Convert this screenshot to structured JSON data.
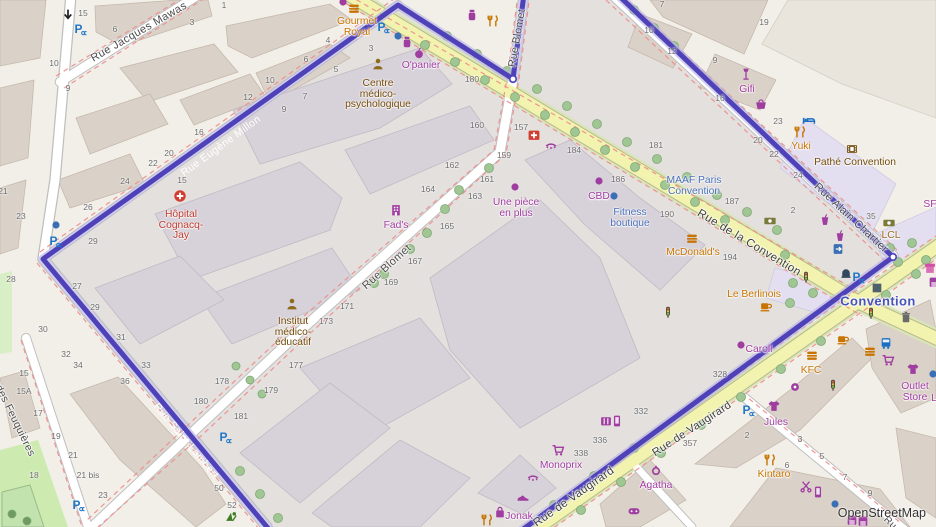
{
  "map": {
    "attribution": "OpenStreetMap",
    "colors": {
      "boundary": "#4f42b8",
      "boundary_halo": "#b9b2e4",
      "road_yellow": "#f2f3ae",
      "land": "#f2efe9",
      "building": "#dad1c8",
      "park": "#cdebb0",
      "shop_label": "#a03da0",
      "food_label": "#c77400",
      "amenity_label": "#734a08",
      "hospital_label": "#c0392b",
      "office_label": "#4a6fb8",
      "station_label": "#4753b8",
      "parking_blue": "#2077c8"
    },
    "street_labels": [
      {
        "text": "Rue Jacques Mawas",
        "x": 139,
        "y": 32,
        "rot": -30,
        "c": "#4a4a4a",
        "fs": 11
      },
      {
        "text": "Rue Eugène Millon",
        "x": 221,
        "y": 146,
        "rot": -36,
        "c": "#ffffff",
        "fs": 10.5,
        "halo": 0
      },
      {
        "text": "Rue Saint-Lambert",
        "x": 186,
        "y": 441,
        "rot": 50,
        "c": "#ffffff",
        "fs": 10.5,
        "halo": 0
      },
      {
        "text": "Rue Blomet",
        "x": 517,
        "y": 38,
        "rot": -80,
        "c": "#4a4a4a",
        "fs": 10.5
      },
      {
        "text": "Rue Blomet",
        "x": 387,
        "y": 267,
        "rot": -42,
        "c": "#4a4a4a",
        "fs": 11
      },
      {
        "text": "Rue de la Convention",
        "x": 749,
        "y": 243,
        "rot": 31,
        "c": "#3e3e3e",
        "fs": 11.5
      },
      {
        "text": "Rue Alain Chartier",
        "x": 851,
        "y": 218,
        "rot": 43,
        "c": "#4a4a4a",
        "fs": 11
      },
      {
        "text": "Rue de Vaugirard",
        "x": 574,
        "y": 497,
        "rot": -35,
        "c": "#3e3e3e",
        "fs": 11.5
      },
      {
        "text": "Rue de Vaugirard",
        "x": 692,
        "y": 429,
        "rot": -33,
        "c": "#3e3e3e",
        "fs": 11
      },
      {
        "text": "Rue des Feuquières",
        "x": 10,
        "y": 410,
        "rot": 64,
        "c": "#4a4a4a",
        "fs": 10.5
      },
      {
        "text": "Convention",
        "x": 878,
        "y": 301,
        "rot": 0,
        "c": "#4753b8",
        "fs": 13,
        "bold": 1
      },
      {
        "text": "Ru",
        "x": 890,
        "y": 523,
        "rot": 45,
        "c": "#4a4a4a",
        "fs": 10
      }
    ],
    "house_numbers": [
      [
        "15",
        83,
        13
      ],
      [
        "10",
        54,
        63
      ],
      [
        "6",
        115,
        29
      ],
      [
        "3",
        192,
        22
      ],
      [
        "1",
        224,
        5
      ],
      [
        "9",
        68,
        88
      ],
      [
        "10",
        270,
        80
      ],
      [
        "12",
        248,
        97
      ],
      [
        "16",
        199,
        132
      ],
      [
        "20",
        169,
        153
      ],
      [
        "22",
        153,
        163
      ],
      [
        "7",
        305,
        96
      ],
      [
        "9",
        284,
        109
      ],
      [
        "6",
        306,
        59
      ],
      [
        "5",
        336,
        69
      ],
      [
        "4",
        328,
        40
      ],
      [
        "3",
        371,
        48
      ],
      [
        "23",
        21,
        216
      ],
      [
        "26",
        88,
        207
      ],
      [
        "24",
        125,
        181
      ],
      [
        "29",
        93,
        241
      ],
      [
        "27",
        77,
        286
      ],
      [
        "29",
        95,
        307
      ],
      [
        "30",
        43,
        329
      ],
      [
        "31",
        121,
        337
      ],
      [
        "28",
        11,
        279
      ],
      [
        "21",
        3,
        191
      ],
      [
        "15",
        182,
        180
      ],
      [
        "180",
        472,
        79
      ],
      [
        "160",
        477,
        125
      ],
      [
        "157",
        521,
        127
      ],
      [
        "159",
        504,
        155
      ],
      [
        "162",
        452,
        165
      ],
      [
        "161",
        487,
        179
      ],
      [
        "164",
        428,
        189
      ],
      [
        "163",
        475,
        196
      ],
      [
        "165",
        447,
        226
      ],
      [
        "167",
        415,
        261
      ],
      [
        "169",
        391,
        282
      ],
      [
        "171",
        347,
        306
      ],
      [
        "173",
        326,
        321
      ],
      [
        "184",
        574,
        150
      ],
      [
        "186",
        618,
        179
      ],
      [
        "187",
        732,
        201
      ],
      [
        "190",
        667,
        214
      ],
      [
        "194",
        730,
        257
      ],
      [
        "2",
        793,
        210
      ],
      [
        "35",
        871,
        216
      ],
      [
        "181",
        656,
        145
      ],
      [
        "23",
        778,
        121
      ],
      [
        "24",
        798,
        175
      ],
      [
        "22",
        774,
        154
      ],
      [
        "20",
        758,
        140
      ],
      [
        "16",
        720,
        98
      ],
      [
        "19",
        764,
        22
      ],
      [
        "12",
        672,
        51
      ],
      [
        "10",
        649,
        30
      ],
      [
        "9",
        715,
        60
      ],
      [
        "7",
        662,
        4
      ],
      [
        "33",
        146,
        365
      ],
      [
        "34",
        78,
        365
      ],
      [
        "36",
        125,
        381
      ],
      [
        "32",
        66,
        354
      ],
      [
        "50",
        219,
        488
      ],
      [
        "52",
        232,
        505
      ],
      [
        "15",
        24,
        373
      ],
      [
        "15A",
        24,
        391
      ],
      [
        "17",
        38,
        413
      ],
      [
        "19",
        56,
        436
      ],
      [
        "21",
        73,
        455
      ],
      [
        "21 bis",
        88,
        475
      ],
      [
        "23",
        103,
        495
      ],
      [
        "18",
        34,
        475
      ],
      [
        "177",
        296,
        365
      ],
      [
        "178",
        222,
        381
      ],
      [
        "179",
        271,
        390
      ],
      [
        "180",
        201,
        401
      ],
      [
        "181",
        241,
        416
      ],
      [
        "336",
        600,
        440
      ],
      [
        "338",
        581,
        453
      ],
      [
        "357",
        690,
        443
      ],
      [
        "328",
        720,
        374
      ],
      [
        "332",
        641,
        411
      ],
      [
        "2",
        747,
        435
      ],
      [
        "3",
        800,
        439
      ],
      [
        "5",
        822,
        456
      ],
      [
        "6",
        787,
        465
      ],
      [
        "7",
        845,
        477
      ],
      [
        "9",
        870,
        493
      ]
    ],
    "pois": [
      {
        "t": "arrow",
        "x": 68,
        "y": 15,
        "c": "#222222"
      },
      {
        "t": "parking",
        "x": 80,
        "y": 29
      },
      {
        "t": "dot",
        "x": 56,
        "y": 225,
        "c": "#3b6fb5"
      },
      {
        "t": "parking",
        "x": 55,
        "y": 241
      },
      {
        "t": "parking",
        "x": 78,
        "y": 505
      },
      {
        "t": "playground",
        "x": 231,
        "y": 516,
        "c": "#3e7d23"
      },
      {
        "t": "parking",
        "x": 225,
        "y": 437
      },
      {
        "t": "parking",
        "x": 383,
        "y": 27
      },
      {
        "t": "burger",
        "x": 354,
        "y": 9,
        "c": "#c77400",
        "l": {
          "lines": [
            "Gourmet",
            "Royal"
          ],
          "c": "#c77400",
          "x": 357,
          "y": 22
        }
      },
      {
        "t": "jar",
        "x": 472,
        "y": 15,
        "c": "#a03da0"
      },
      {
        "t": "cutlery",
        "x": 493,
        "y": 21,
        "c": "#c77400"
      },
      {
        "t": "jar",
        "x": 407,
        "y": 42,
        "c": "#a03da0"
      },
      {
        "t": "apple",
        "x": 419,
        "y": 53,
        "c": "#a03da0",
        "l": {
          "lines": [
            "O'panier"
          ],
          "c": "#a03da0",
          "x": 421,
          "y": 66
        }
      },
      {
        "t": "dot",
        "x": 343,
        "y": 2,
        "c": "#a03da0"
      },
      {
        "t": "dot",
        "x": 398,
        "y": 36,
        "c": "#3b6fb5"
      },
      {
        "t": "person",
        "x": 378,
        "y": 64,
        "c": "#8d6c1b",
        "l": {
          "lines": [
            "Centre",
            "médico-",
            "psychologique"
          ],
          "c": "#734a08",
          "x": 378,
          "y": 84
        }
      },
      {
        "t": "hospital",
        "x": 180,
        "y": 196,
        "l": {
          "lines": [
            "Hôpital",
            "Cognacq-",
            "Jay"
          ],
          "c": "#c0392b",
          "x": 181,
          "y": 215
        }
      },
      {
        "t": "person",
        "x": 292,
        "y": 304,
        "c": "#8d6c1b",
        "l": {
          "lines": [
            "Institut",
            "médico-",
            "éducatif"
          ],
          "c": "#734a08",
          "x": 293,
          "y": 322
        }
      },
      {
        "t": "building",
        "x": 396,
        "y": 210,
        "c": "#a03da0",
        "l": {
          "lines": [
            "Fad's"
          ],
          "c": "#a03da0",
          "x": 396,
          "y": 226
        }
      },
      {
        "t": "dot",
        "x": 515,
        "y": 187,
        "c": "#a03da0",
        "l": {
          "lines": [
            "Une pièce",
            "en plus"
          ],
          "c": "#a03da0",
          "x": 516,
          "y": 203
        }
      },
      {
        "t": "dot",
        "x": 599,
        "y": 181,
        "c": "#a03da0",
        "l": {
          "lines": [
            "CBD"
          ],
          "c": "#a03da0",
          "x": 599,
          "y": 197
        }
      },
      {
        "t": "dot",
        "x": 614,
        "y": 196,
        "c": "#3b6fb5",
        "l": {
          "lines": [
            "Fitness",
            "boutique"
          ],
          "c": "#4a6fb8",
          "x": 630,
          "y": 213
        }
      },
      {
        "l": {
          "lines": [
            "MAAF Paris",
            "Convention"
          ],
          "c": "#4a6fb8",
          "x": 694,
          "y": 181
        }
      },
      {
        "t": "burger",
        "x": 692,
        "y": 239,
        "c": "#c77400",
        "l": {
          "lines": [
            "McDonald's"
          ],
          "c": "#c77400",
          "x": 693,
          "y": 253
        }
      },
      {
        "t": "cup",
        "x": 766,
        "y": 306,
        "c": "#c77400",
        "l": {
          "lines": [
            "Le Berlinois"
          ],
          "c": "#c77400",
          "x": 754,
          "y": 295
        }
      },
      {
        "t": "dot",
        "x": 741,
        "y": 345,
        "c": "#a03da0",
        "l": {
          "lines": [
            "Caroll"
          ],
          "c": "#a03da0",
          "x": 759,
          "y": 350
        }
      },
      {
        "t": "lamp",
        "x": 746,
        "y": 74,
        "c": "#a03da0",
        "l": {
          "lines": [
            "Gifi"
          ],
          "c": "#a03da0",
          "x": 747,
          "y": 90
        }
      },
      {
        "t": "basket",
        "x": 761,
        "y": 104,
        "c": "#a03da0"
      },
      {
        "t": "bed",
        "x": 809,
        "y": 120,
        "c": "#1a6fc4"
      },
      {
        "t": "cutlery",
        "x": 800,
        "y": 132,
        "c": "#c77400",
        "l": {
          "lines": [
            "Yuki"
          ],
          "c": "#c77400",
          "x": 801,
          "y": 147
        }
      },
      {
        "t": "film",
        "x": 852,
        "y": 149,
        "c": "#734a08",
        "l": {
          "lines": [
            "Pathé Convention"
          ],
          "c": "#734a08",
          "x": 855,
          "y": 163
        }
      },
      {
        "t": "banknote",
        "x": 770,
        "y": 221,
        "c": "#7a7a3d"
      },
      {
        "t": "banknote",
        "x": 889,
        "y": 223,
        "c": "#7a7a3d",
        "l": {
          "lines": [
            "LCL"
          ],
          "c": "#9a6d1f",
          "x": 891,
          "y": 236
        }
      },
      {
        "t": "drink",
        "x": 825,
        "y": 220,
        "c": "#a03da0"
      },
      {
        "t": "drink",
        "x": 840,
        "y": 236,
        "c": "#a03da0"
      },
      {
        "t": "door",
        "x": 838,
        "y": 249,
        "c": "#3b6fb5"
      },
      {
        "t": "fountain",
        "x": 846,
        "y": 272,
        "c": "#32495f"
      },
      {
        "t": "parking",
        "x": 858,
        "y": 277
      },
      {
        "t": "subway",
        "x": 877,
        "y": 288,
        "c": "#50616e"
      },
      {
        "t": "trash",
        "x": 906,
        "y": 317,
        "c": "#6a6a6a"
      },
      {
        "t": "cup",
        "x": 843,
        "y": 339,
        "c": "#c77400"
      },
      {
        "t": "traffic",
        "x": 806,
        "y": 277
      },
      {
        "t": "traffic",
        "x": 871,
        "y": 313
      },
      {
        "t": "traffic",
        "x": 833,
        "y": 385
      },
      {
        "t": "traffic",
        "x": 668,
        "y": 312
      },
      {
        "t": "bus",
        "x": 886,
        "y": 343,
        "c": "#1a6fc4"
      },
      {
        "t": "burger",
        "x": 870,
        "y": 352,
        "c": "#c77400"
      },
      {
        "t": "cart",
        "x": 888,
        "y": 360,
        "c": "#a03da0"
      },
      {
        "t": "tshirt",
        "x": 913,
        "y": 369,
        "c": "#a03da0",
        "l": {
          "lines": [
            "Outlet",
            "Store"
          ],
          "c": "#a03da0",
          "x": 915,
          "y": 387
        }
      },
      {
        "t": "dot",
        "x": 933,
        "y": 374,
        "c": "#3b6fb5"
      },
      {
        "l": {
          "lines": [
            "L"
          ],
          "c": "#a03da0",
          "x": 934,
          "y": 399
        }
      },
      {
        "t": "burger",
        "x": 812,
        "y": 356,
        "c": "#c77400",
        "l": {
          "lines": [
            "KFC"
          ],
          "c": "#c77400",
          "x": 811,
          "y": 371
        }
      },
      {
        "t": "tshirt",
        "x": 774,
        "y": 406,
        "c": "#a03da0",
        "l": {
          "lines": [
            "Jules"
          ],
          "c": "#a03da0",
          "x": 776,
          "y": 423
        }
      },
      {
        "t": "parking",
        "x": 748,
        "y": 410
      },
      {
        "t": "donut",
        "x": 795,
        "y": 387,
        "c": "#a03da0"
      },
      {
        "t": "cutlery",
        "x": 770,
        "y": 460,
        "c": "#c77400",
        "l": {
          "lines": [
            "Kintaro"
          ],
          "c": "#c77400",
          "x": 774,
          "y": 475
        }
      },
      {
        "t": "ring",
        "x": 656,
        "y": 470,
        "c": "#a03da0",
        "l": {
          "lines": [
            "Agatha"
          ],
          "c": "#a03da0",
          "x": 656,
          "y": 486
        }
      },
      {
        "t": "controller",
        "x": 634,
        "y": 511,
        "c": "#a03da0"
      },
      {
        "t": "scissors",
        "x": 806,
        "y": 486,
        "c": "#a03da0"
      },
      {
        "t": "phone",
        "x": 818,
        "y": 492,
        "c": "#a03da0"
      },
      {
        "t": "dot",
        "x": 835,
        "y": 504,
        "c": "#3b6fb5"
      },
      {
        "t": "shopfront",
        "x": 852,
        "y": 520,
        "c": "#a03da0"
      },
      {
        "t": "shopfront",
        "x": 863,
        "y": 521,
        "c": "#a03da0"
      },
      {
        "t": "book",
        "x": 606,
        "y": 421,
        "c": "#a03da0"
      },
      {
        "t": "phone",
        "x": 617,
        "y": 421,
        "c": "#a03da0"
      },
      {
        "t": "cart",
        "x": 558,
        "y": 450,
        "c": "#a03da0",
        "l": {
          "lines": [
            "Monoprix"
          ],
          "c": "#a03da0",
          "x": 561,
          "y": 466
        }
      },
      {
        "t": "eyelash",
        "x": 533,
        "y": 478,
        "c": "#a03da0"
      },
      {
        "t": "shoe",
        "x": 523,
        "y": 497,
        "c": "#a03da0"
      },
      {
        "t": "bag",
        "x": 500,
        "y": 512,
        "c": "#a03da0",
        "l": {
          "lines": [
            "Jonak"
          ],
          "c": "#a03da0",
          "x": 519,
          "y": 517
        }
      },
      {
        "t": "cutlery",
        "x": 487,
        "y": 520,
        "c": "#c77400"
      },
      {
        "t": "redcross",
        "x": 534,
        "y": 135
      },
      {
        "t": "eyelash",
        "x": 551,
        "y": 146,
        "c": "#a03da0"
      },
      {
        "l": {
          "lines": [
            "SF"
          ],
          "c": "#a03da0",
          "x": 930,
          "y": 205
        }
      },
      {
        "t": "awning",
        "x": 930,
        "y": 268,
        "c": "#d24fa8"
      },
      {
        "t": "shopfront",
        "x": 934,
        "y": 282,
        "c": "#a03da0"
      }
    ]
  }
}
